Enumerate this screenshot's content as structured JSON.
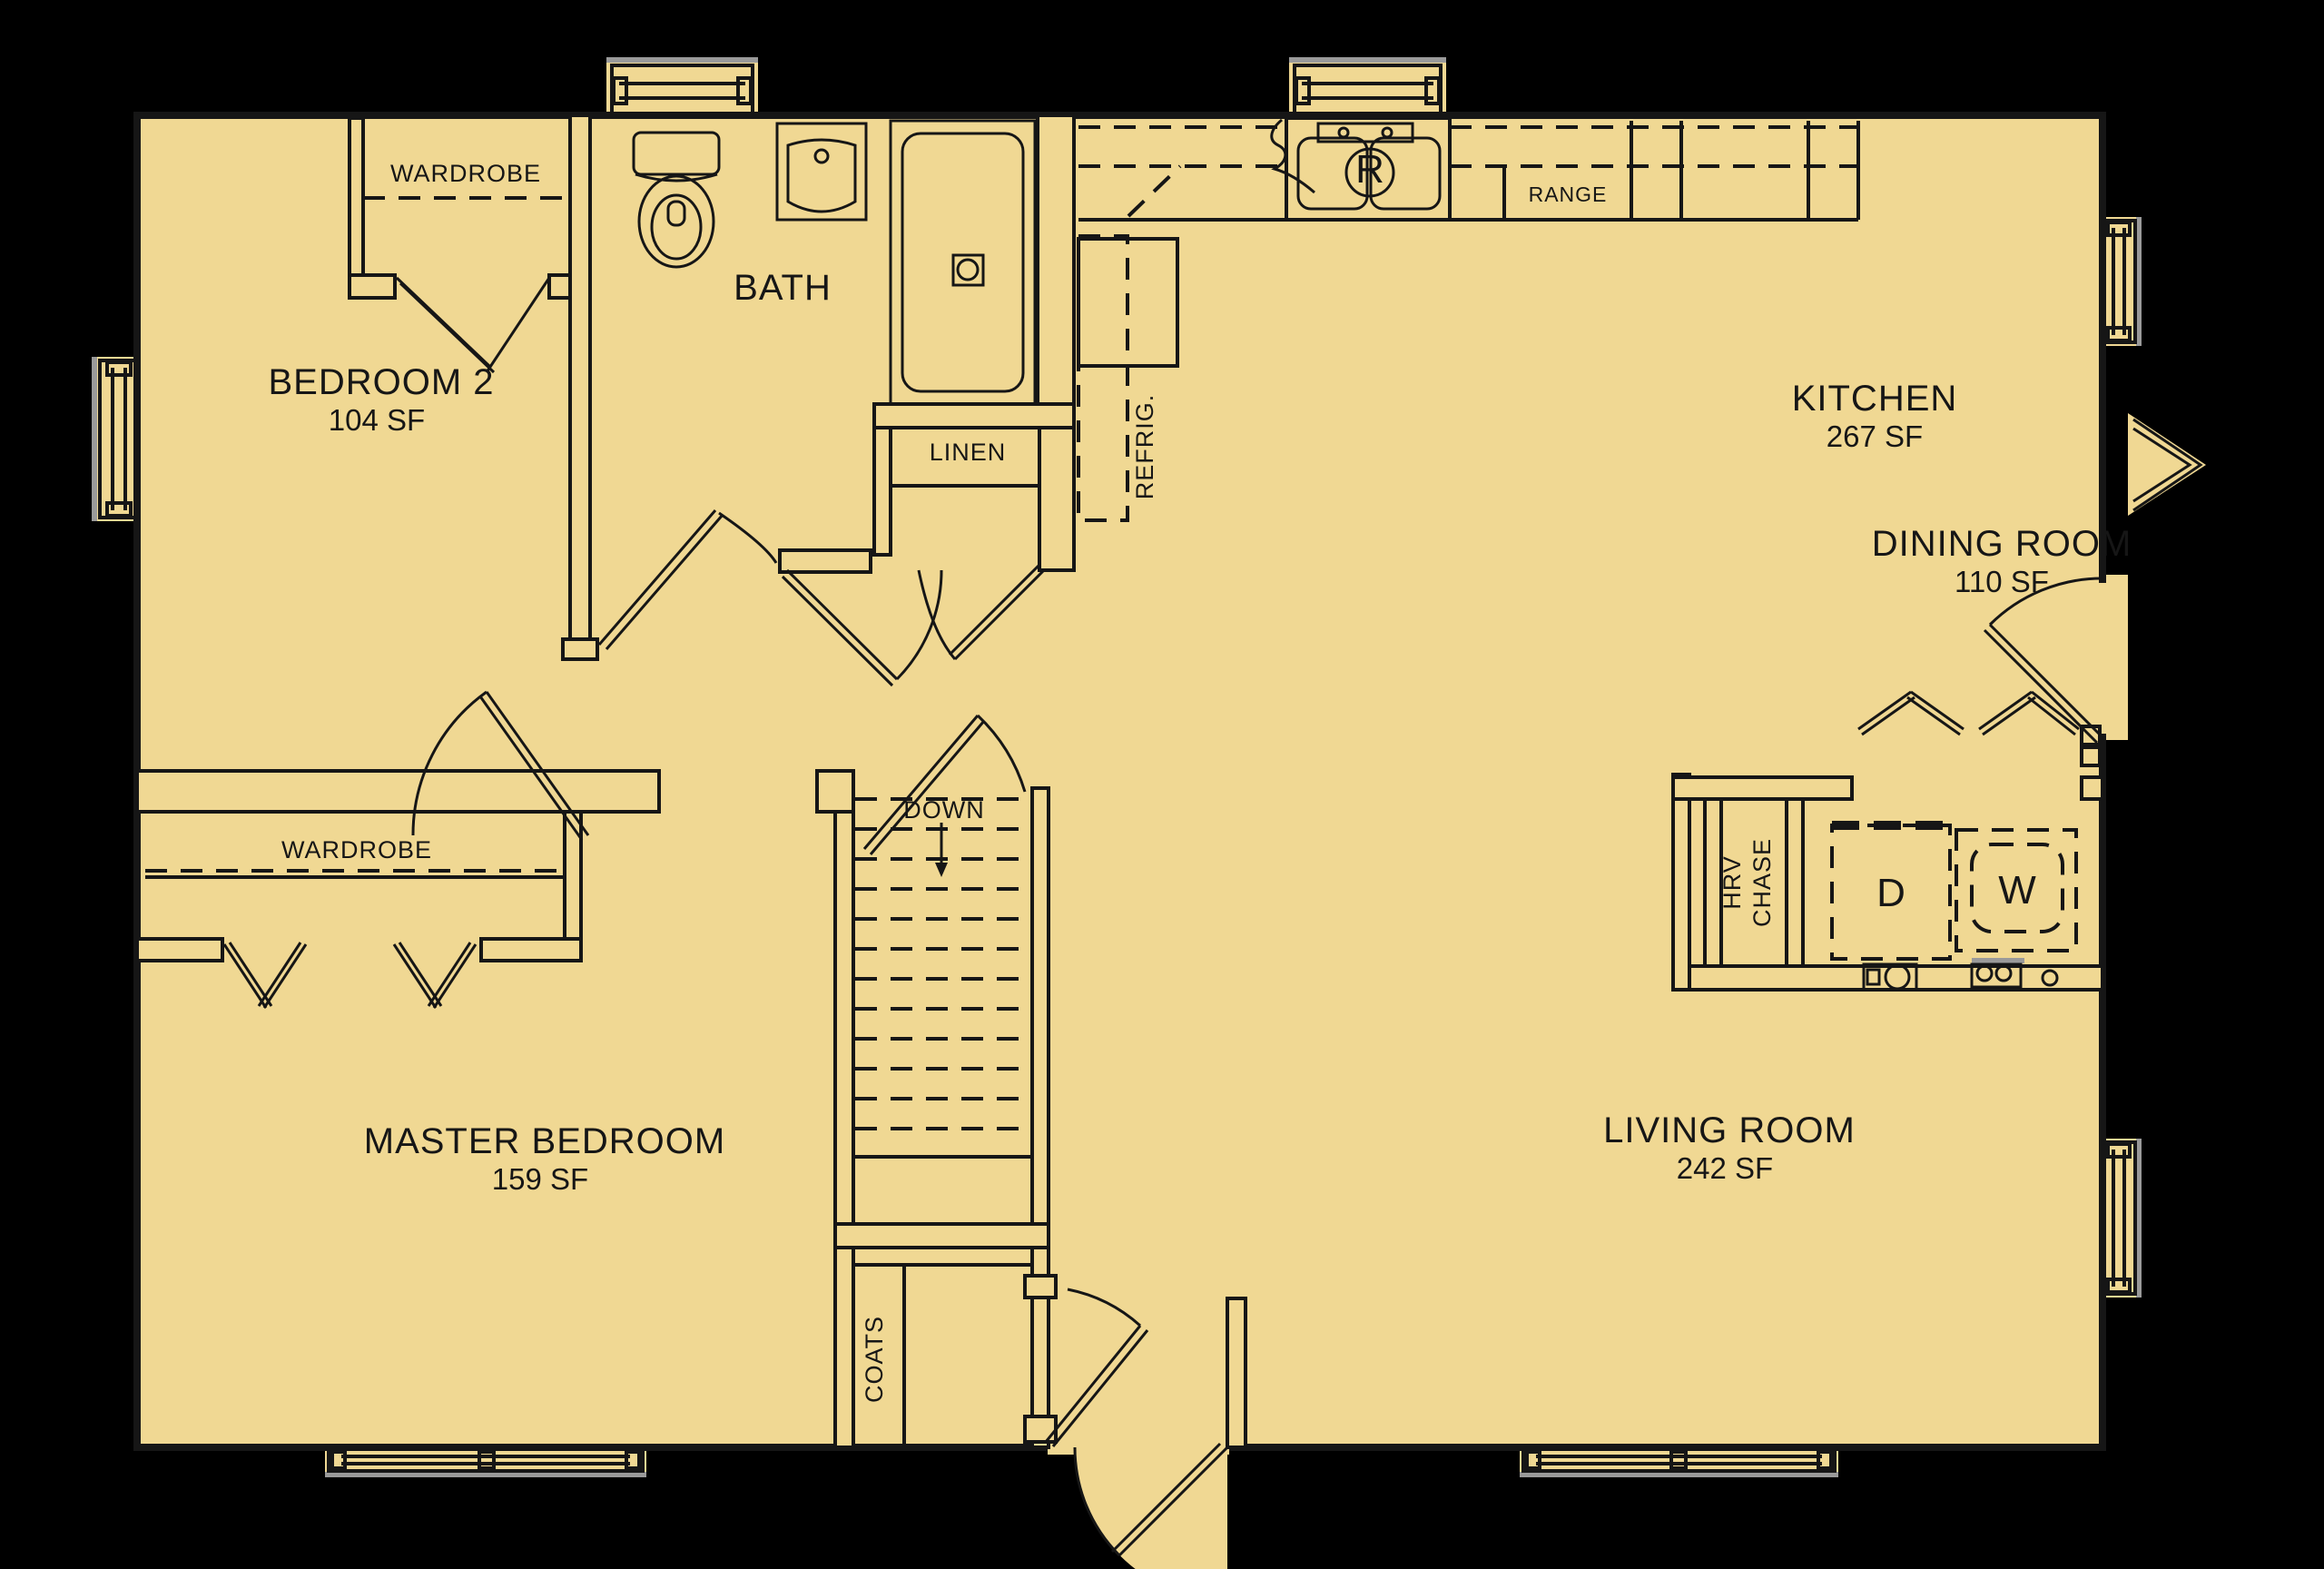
{
  "plan": {
    "colors": {
      "background": "#000000",
      "floor": "#F0D893",
      "line": "#161616",
      "shadow": "#9a9a9a"
    },
    "rooms": [
      {
        "name": "BEDROOM 2",
        "area": "104 SF"
      },
      {
        "name": "BATH"
      },
      {
        "name": "KITCHEN",
        "area": "267 SF"
      },
      {
        "name": "DINING ROOM",
        "area": "110 SF"
      },
      {
        "name": "MASTER BEDROOM",
        "area": "159 SF"
      },
      {
        "name": "LIVING ROOM",
        "area": "242 SF"
      }
    ],
    "labels": {
      "wardrobe_bedroom2": "WARDROBE",
      "wardrobe_master": "WARDROBE",
      "linen": "LINEN",
      "range": "RANGE",
      "refrig": "REFRIG.",
      "down": "DOWN",
      "coats": "COATS",
      "hrv_line_1": "HRV",
      "hrv_line_2": "CHASE",
      "dryer": "D",
      "washer": "W",
      "disposal": "R"
    }
  }
}
